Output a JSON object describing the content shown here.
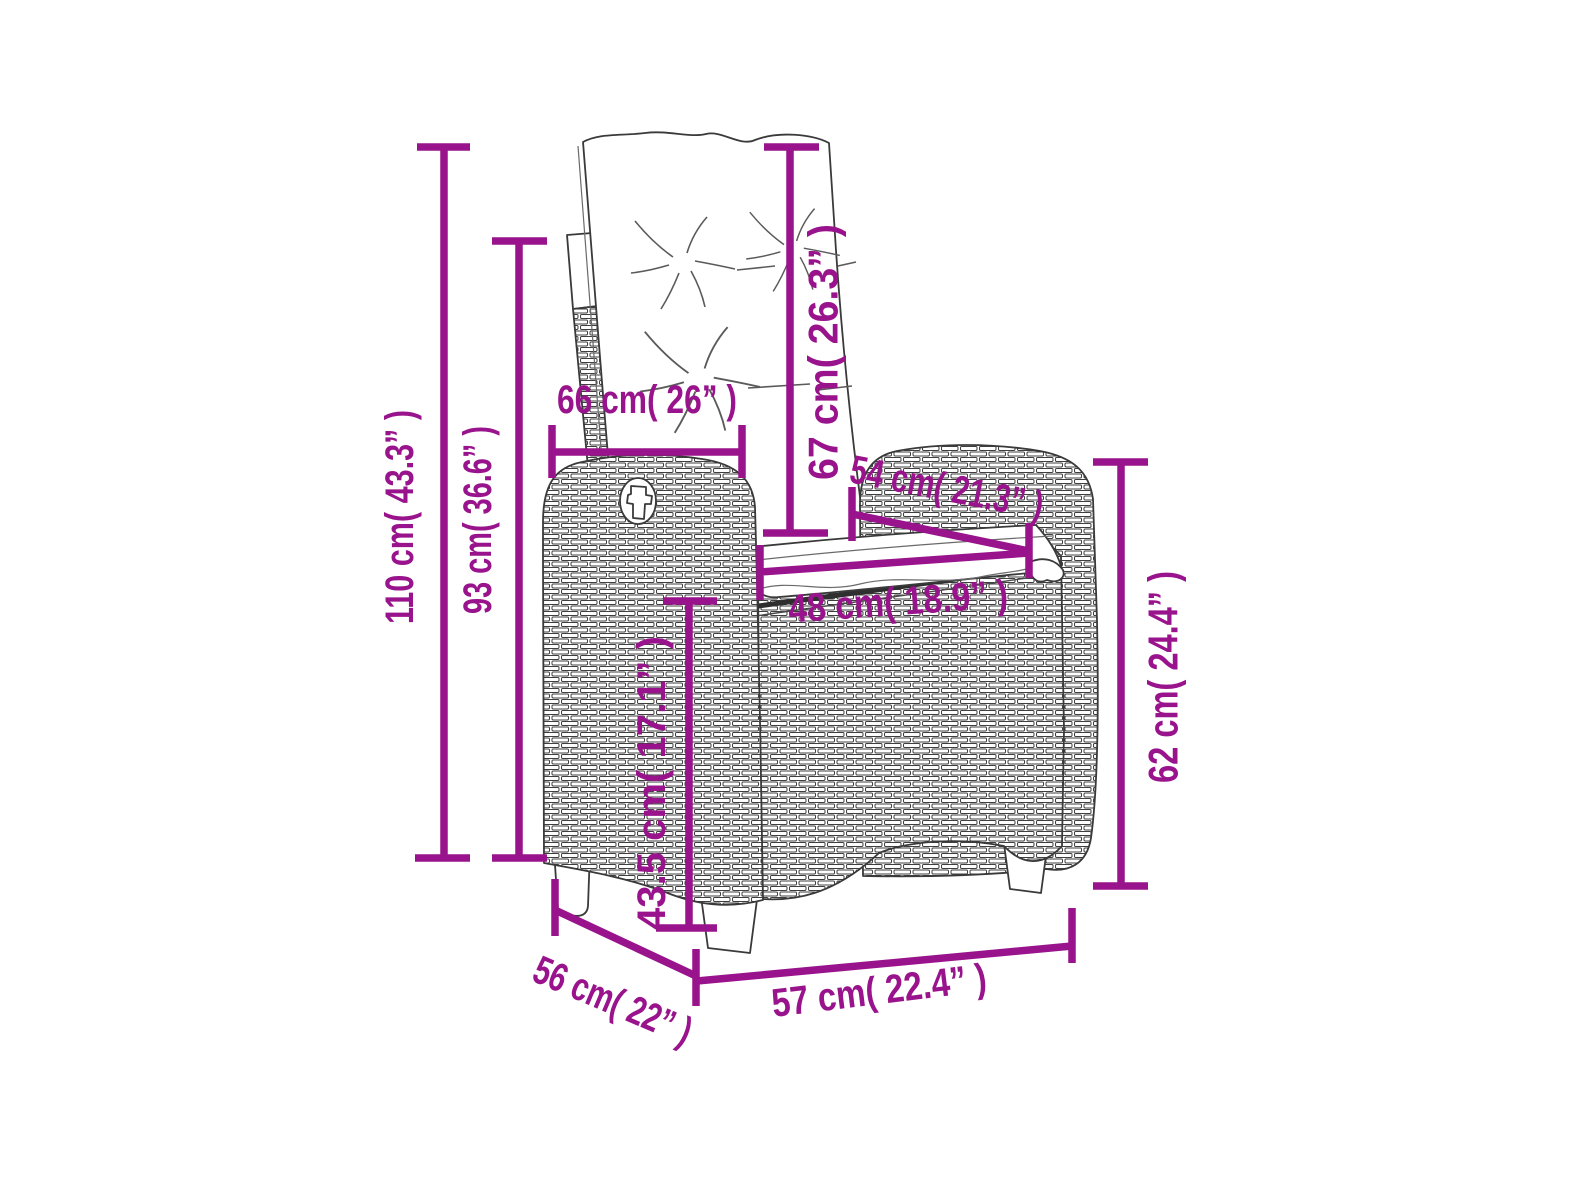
{
  "figure": {
    "subject": "wicker-reclining-garden-chair-line-drawing",
    "accent_color": "#99148C",
    "art_color": "#3a3a3a",
    "background": "#ffffff"
  },
  "dimensions": [
    {
      "id": "total-height",
      "label": "110 cm( 43.3” )",
      "value_cm": 110,
      "value_in": 43.3,
      "orientation": "vertical"
    },
    {
      "id": "backrest-top-height",
      "label": "93 cm( 36.6” )",
      "value_cm": 93,
      "value_in": 36.6,
      "orientation": "vertical"
    },
    {
      "id": "back-cushion-width",
      "label": "66 cm( 26” )",
      "value_cm": 66,
      "value_in": 26,
      "orientation": "horizontal"
    },
    {
      "id": "back-cushion-height",
      "label": "67 cm( 26.3” )",
      "value_cm": 67,
      "value_in": 26.3,
      "orientation": "vertical"
    },
    {
      "id": "seat-depth-diagonal",
      "label": "54 cm( 21.3” )",
      "value_cm": 54,
      "value_in": 21.3,
      "orientation": "diagonal"
    },
    {
      "id": "seat-width",
      "label": "48 cm( 18.9” )",
      "value_cm": 48,
      "value_in": 18.9,
      "orientation": "horizontal"
    },
    {
      "id": "seat-height",
      "label": "43.5 cm( 17.1” )",
      "value_cm": 43.5,
      "value_in": 17.1,
      "orientation": "vertical"
    },
    {
      "id": "armrest-height",
      "label": "62 cm( 24.4” )",
      "value_cm": 62,
      "value_in": 24.4,
      "orientation": "vertical"
    },
    {
      "id": "base-depth",
      "label": "56 cm( 22” )",
      "value_cm": 56,
      "value_in": 22,
      "orientation": "diagonal"
    },
    {
      "id": "base-width",
      "label": "57 cm( 22.4” )",
      "value_cm": 57,
      "value_in": 22.4,
      "orientation": "horizontal"
    }
  ]
}
